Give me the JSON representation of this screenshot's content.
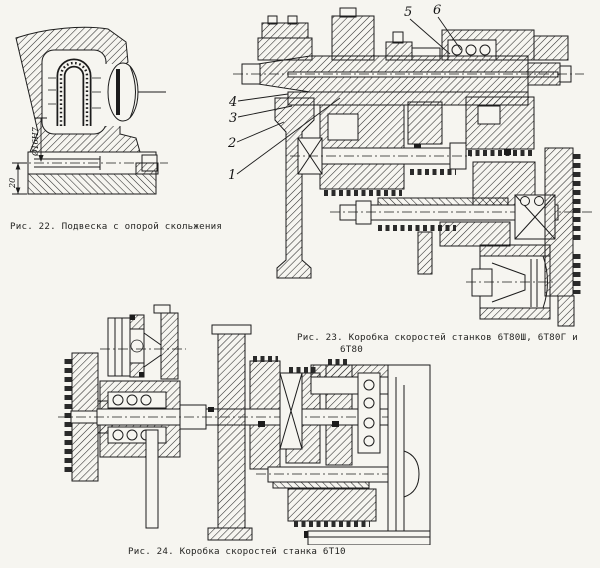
{
  "page": {
    "background": "#f6f5f0",
    "ink": "#1c1c1c"
  },
  "fig22": {
    "caption": "Рис. 22. Подвеска с опорой скольжения",
    "dim_diameter": "Ø16Н7",
    "dim_offset": "20"
  },
  "fig23": {
    "caption_line1": "Рис. 23. Коробка скоростей станков 6Т80Ш, 6Т80Г и",
    "caption_line2": "6Т80",
    "labels": {
      "l1": "1",
      "l2": "2",
      "l3": "3",
      "l4": "4",
      "l5": "5",
      "l6": "6"
    }
  },
  "fig24": {
    "caption": "Рис. 24. Коробка скоростей станка 6Т10"
  }
}
